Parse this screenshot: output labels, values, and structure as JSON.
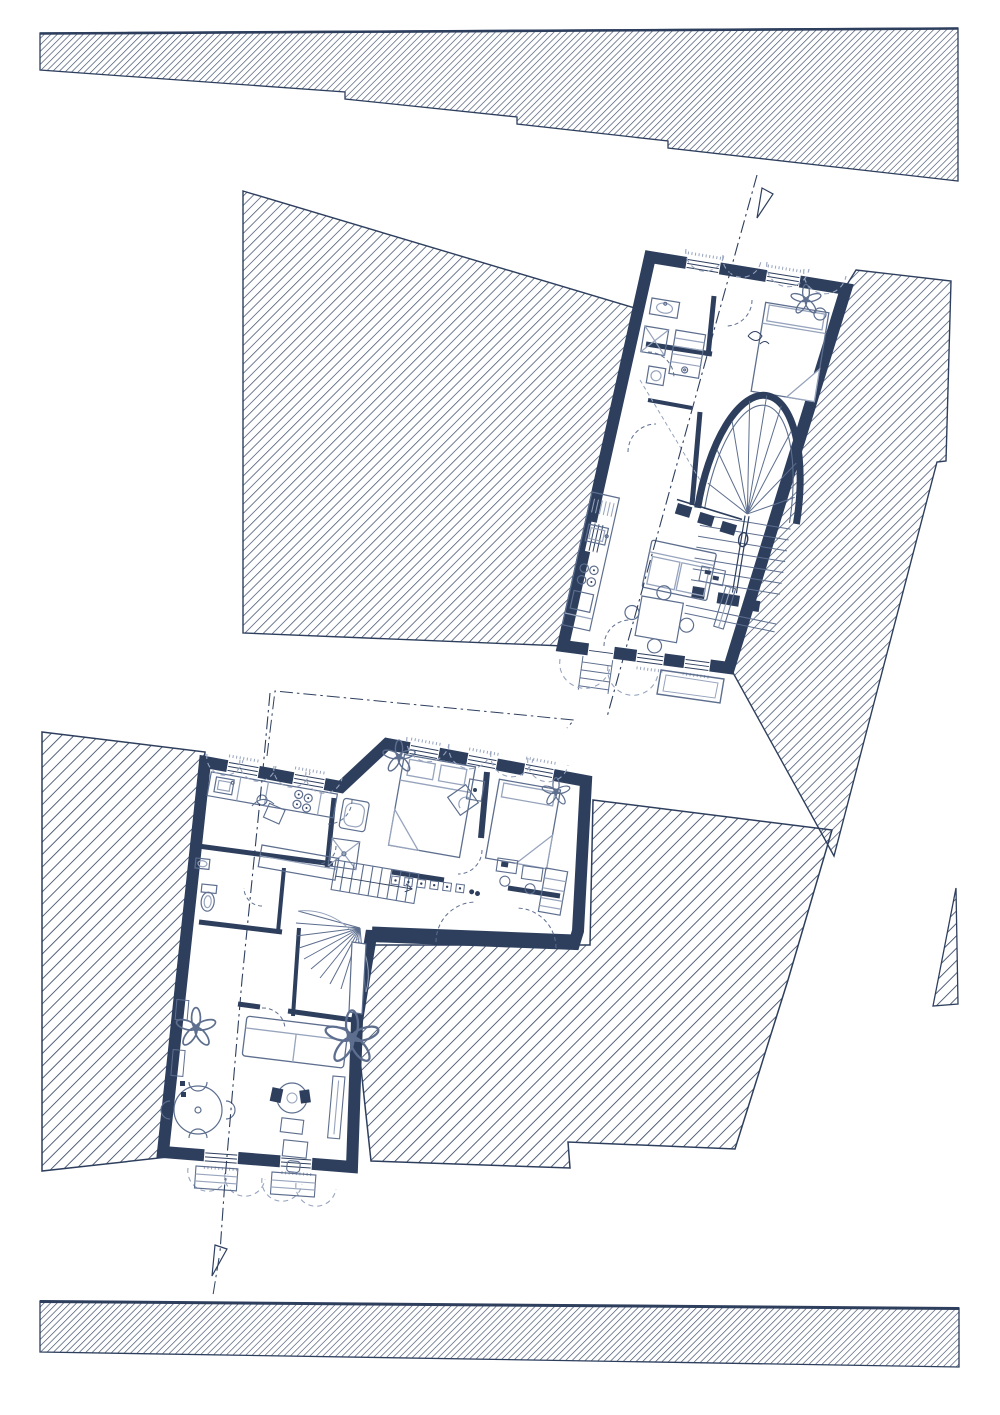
{
  "colors": {
    "ink": "#2e3f5e",
    "mid": "#5d6e8e",
    "light": "#97a4bd",
    "paper": "#ffffff"
  },
  "drawing": {
    "kind": "architectural floor plans with hatched site context",
    "text_labels": [],
    "site_areas": [
      "boundary-band-top",
      "parcel-upper-left",
      "parcel-upper-right",
      "parcel-lower-left",
      "parcel-lower-right",
      "parcel-sliver-right",
      "boundary-band-bottom"
    ],
    "upper_plan": {
      "rooms": [
        "bathroom",
        "wardrobe",
        "bedroom",
        "stair-hall",
        "kitchen",
        "living-room",
        "dining-area"
      ],
      "features": [
        "arched-winder-staircase",
        "balcony",
        "entry-steps",
        "window-shutter-arcs",
        "door-swing-arcs",
        "section-line"
      ]
    },
    "lower_plan": {
      "rooms": [
        "kitchen",
        "bathroom",
        "wc",
        "hallway",
        "bedroom-1",
        "bedroom-2",
        "living-room"
      ],
      "features": [
        "straight-staircase",
        "spiral-staircase",
        "window-shutter-arcs",
        "door-swing-arcs",
        "section-line",
        "radiator-row",
        "wardrobe"
      ]
    }
  }
}
